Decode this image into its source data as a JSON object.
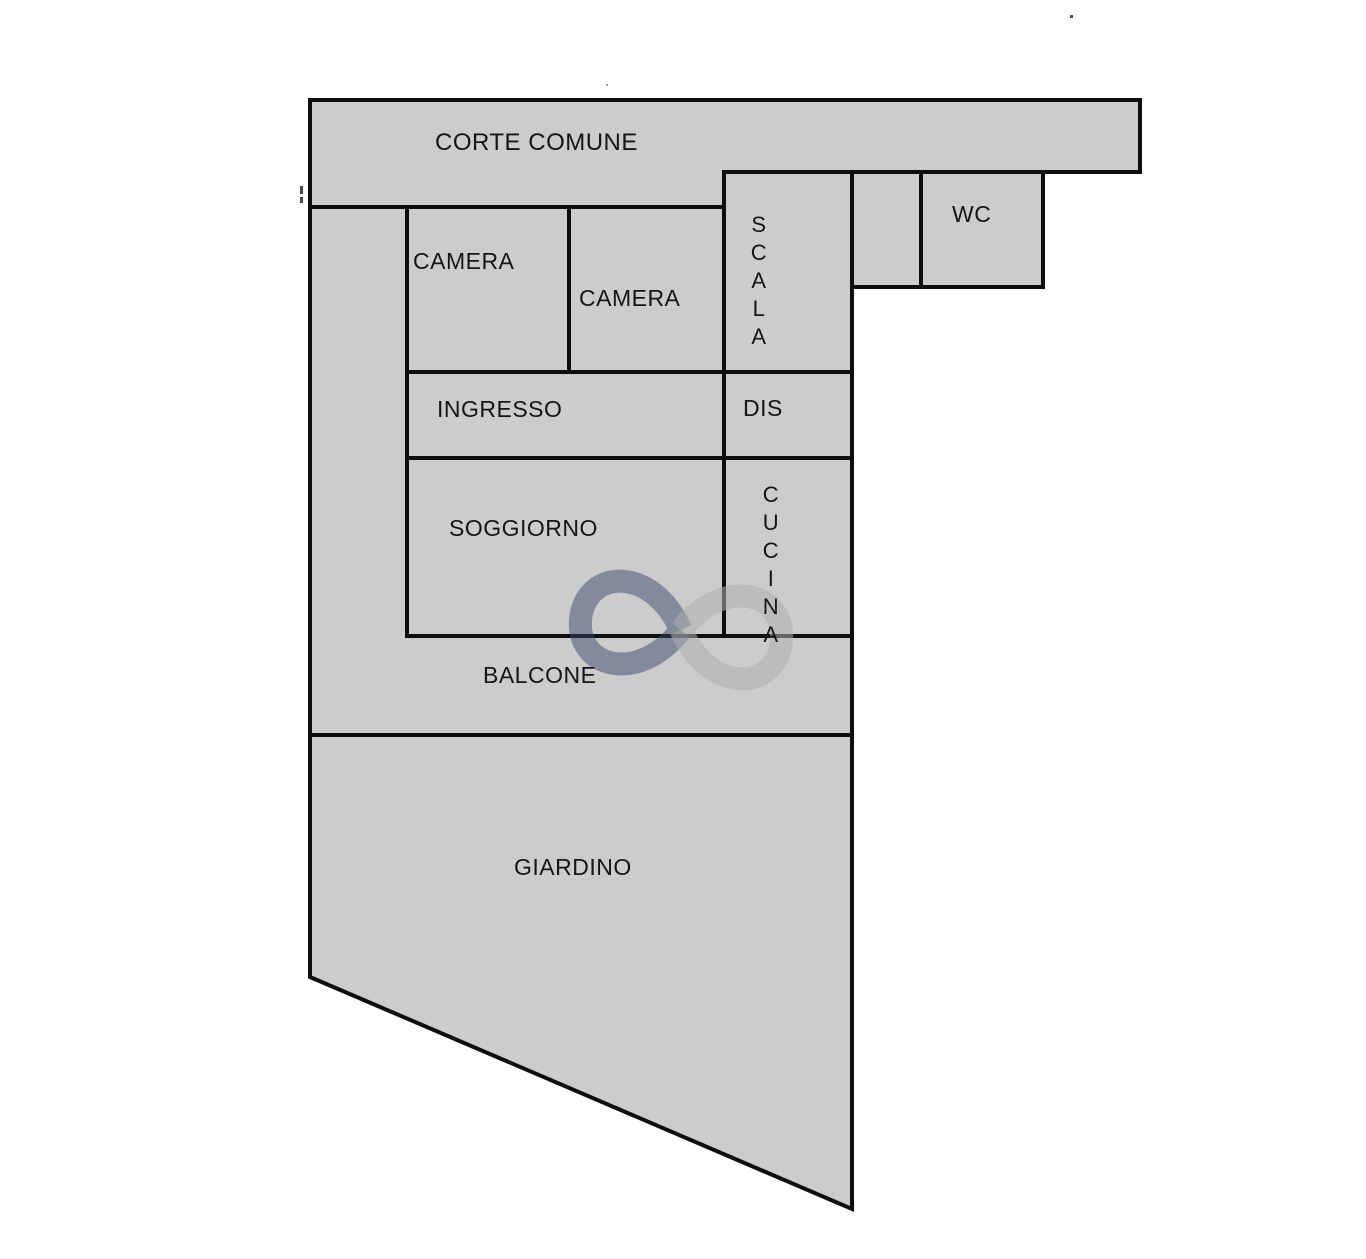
{
  "plan": {
    "background": "#ffffff",
    "outline_color": "#0e0e0e",
    "rooms": {
      "corte_comune": {
        "label": "CORTE COMUNE",
        "color": "#C3C3C3"
      },
      "scala": {
        "label": "SCALA",
        "color": "#990F23"
      },
      "lightblue_room": {
        "label": "",
        "color": "#A6DAEC"
      },
      "wc": {
        "label": "WC",
        "color": "#14A0E6"
      },
      "camera_1": {
        "label": "CAMERA",
        "color": "#FAC20D"
      },
      "camera_2": {
        "label": "CAMERA",
        "color": "#A4D514"
      },
      "ingresso": {
        "label": "INGRESSO",
        "color": "#F9AAC8"
      },
      "dis": {
        "label": "DIS",
        "color": "#E9DDA9"
      },
      "soggiorno": {
        "label": "SOGGIORNO",
        "color": "#C6BCE3"
      },
      "cucina": {
        "label": "CUCINA",
        "color": "#EE1C23"
      },
      "balcone": {
        "label": "BALCONE",
        "color": "#B87A52"
      },
      "giardino": {
        "label": "GIARDINO",
        "color": "#2BA84A"
      }
    },
    "watermark": {
      "name": "infinity-symbol",
      "left_loop_color": "rgba(56,72,108,0.50)",
      "right_loop_color": "rgba(175,175,175,0.55)"
    }
  }
}
